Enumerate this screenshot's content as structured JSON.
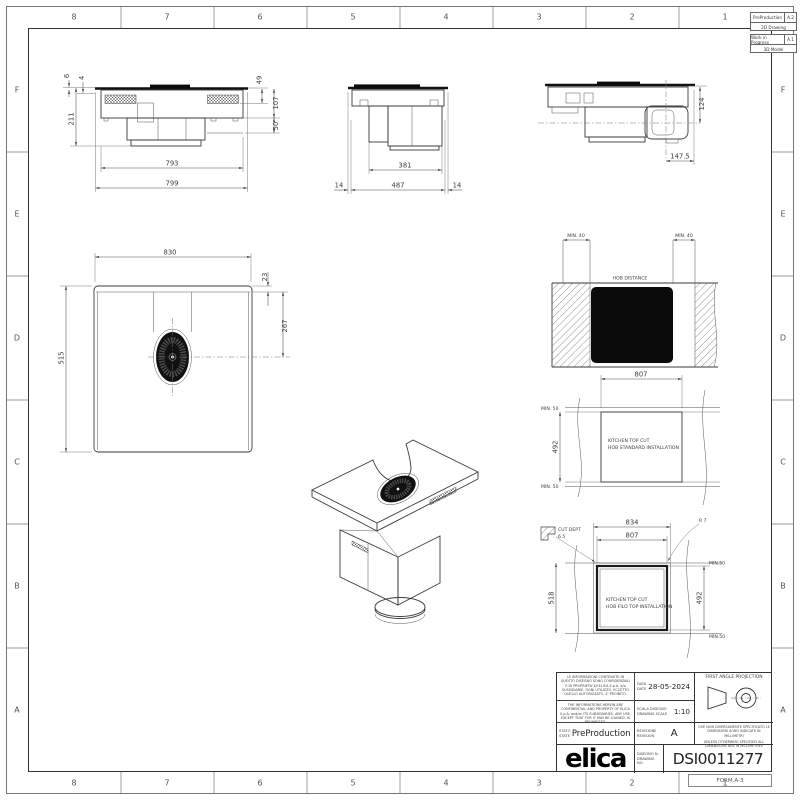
{
  "sheet": {
    "form": "FORM.A-3",
    "cols": [
      "8",
      "7",
      "6",
      "5",
      "4",
      "3",
      "2",
      "1"
    ],
    "rows": [
      "F",
      "E",
      "D",
      "C",
      "B",
      "A"
    ]
  },
  "status": {
    "b1_name": "PreProduction",
    "b1_code": "A.2",
    "b1_type": "2D Drawing",
    "b2_name": "Work in Progress",
    "b2_code": "A.1",
    "b2_type": "3D Model"
  },
  "views": {
    "front": {
      "d6": "6",
      "d4": "4",
      "d211": "211",
      "d49": "49",
      "d107": "107",
      "d50": "50",
      "d793": "793",
      "d799": "799"
    },
    "side": {
      "d381": "381",
      "d487": "487",
      "d14a": "14",
      "d14b": "14"
    },
    "end": {
      "d124": "124",
      "d147": "147.5"
    },
    "plan": {
      "d830": "830",
      "d23": "23",
      "d267": "267",
      "d515": "515"
    },
    "hob_distance": {
      "title": "HOB DISTANCE",
      "min_l": "MIN. 40",
      "min_r": "MIN. 40"
    },
    "std_cut": {
      "d807": "807",
      "min_t": "MIN. 50",
      "d492": "492",
      "min_b": "MIN. 50",
      "l1": "KITCHEN TOP CUT",
      "l2": "HOB STANDARD INSTALLATION"
    },
    "flush_cut": {
      "d834": "834",
      "d807": "807",
      "d518": "518",
      "d492": "492",
      "min_t": "MIN.50",
      "min_b": "MIN.50",
      "r": "R 7",
      "cd1": "CUT DEPT",
      "cd2": "6.5",
      "l1": "KITCHEN TOP CUT",
      "l2": "HOB FILO TOP INSTALLATION"
    }
  },
  "title_block": {
    "conf_it": "LE INFORMAZIONI CONTENUTE IN QUESTO DISEGNO SONO CONFIDENZIALI E DI PROPRIETA' DI ELICA S.p.A. e/o SUSSIDIARIE. OGNI UTILIZZO, ECCETTO QUELLO AUTORIZZATO, E' PROIBITO.",
    "conf_en": "THE INFORMATIONS HEREIN ARE CONFIDENTIAL AND PROPERTY OF ELICA S.p.A. and/or ITS SUBSIDIARIES. ANY USE, EXCEPT THAT FOR IT MAY BE LOANED, IS PROHIBITED.",
    "stato": "STATO",
    "state": "STATE",
    "state_value": "PreProduction",
    "data": "DATA",
    "date": "DATE",
    "date_value": "28-05-2024",
    "scala": "SCALA DISEGNO",
    "scale": "DRAWING SCALE",
    "scale_value": "1:10",
    "revisione": "REVISIONE",
    "revision": "REVISION",
    "revision_value": "A",
    "disegno": "DISEGNO N.",
    "drawing_no": "DRAWING NO.",
    "drawing_no_value": "DSI0011277",
    "projection": "FIRST ANGLE PROJECTION",
    "units_it": "OVE NON DIVERSAMENTE SPECIFICATO LE DIMENSIONI SONO INDICATE IN MILLIMETRI",
    "units_en": "UNLESS OTHERWISE SPECIFIED ALL DIMENSIONS ARE IN MILLIMETRES",
    "logo": "elica"
  }
}
